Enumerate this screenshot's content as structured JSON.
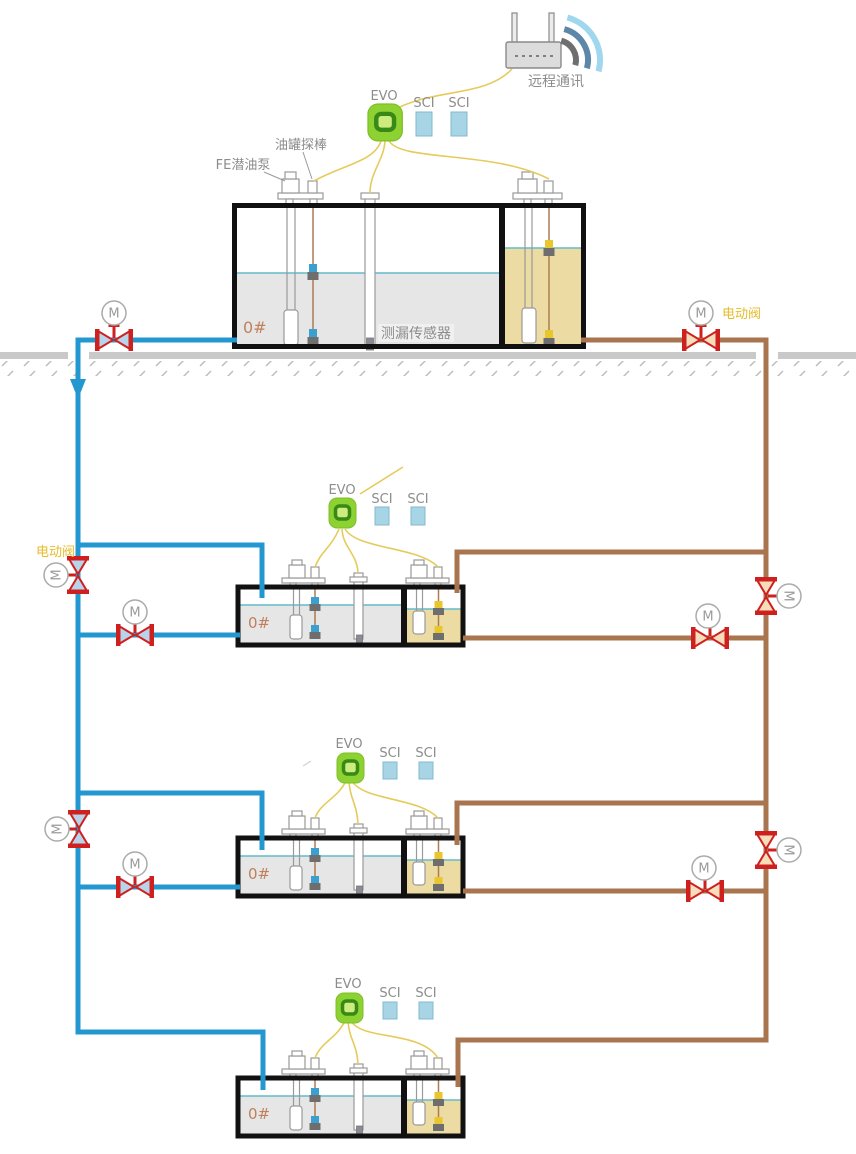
{
  "labels": {
    "remote_comm": "远程通讯",
    "evo_controller": "EVO",
    "sci_module": "SCI",
    "tank_probe": "油罐探棒",
    "fe_submersible_pump": "FE潜油泵",
    "leak_sensor": "测漏传感器",
    "electric_valve": "电动阀",
    "motor_valve": "M",
    "fuel_grade": "0#"
  },
  "icons": {
    "router": "wifi-router-icon",
    "wifi_signal": "wifi-signal-arcs-icon",
    "motor_valve": "motorized-valve-icon",
    "flow_arrow": "down-arrow-icon"
  },
  "colors": {
    "supply_pipe_blue": "#2397cf",
    "return_pipe_brown": "#a8754e",
    "valve_red": "#cf2020",
    "valve_fill_blue": "#b8d4ea",
    "valve_fill_tan": "#f7debb",
    "signal_wire_yellow": "#e5cb5a",
    "evo_green": "#8ed133",
    "evo_ring_green": "#378a15",
    "sci_blue": "#a7d5e6",
    "fuel_gray": "#e6e6e6",
    "fuel_khaki": "#ecdca4",
    "level_line_cyan": "#62bccb",
    "ground_gray": "#c9c9c9",
    "label_gray": "#8c8c8c",
    "grade_text_orange": "#c0805c",
    "electric_valve_label_yellow": "#e6bb2a"
  }
}
